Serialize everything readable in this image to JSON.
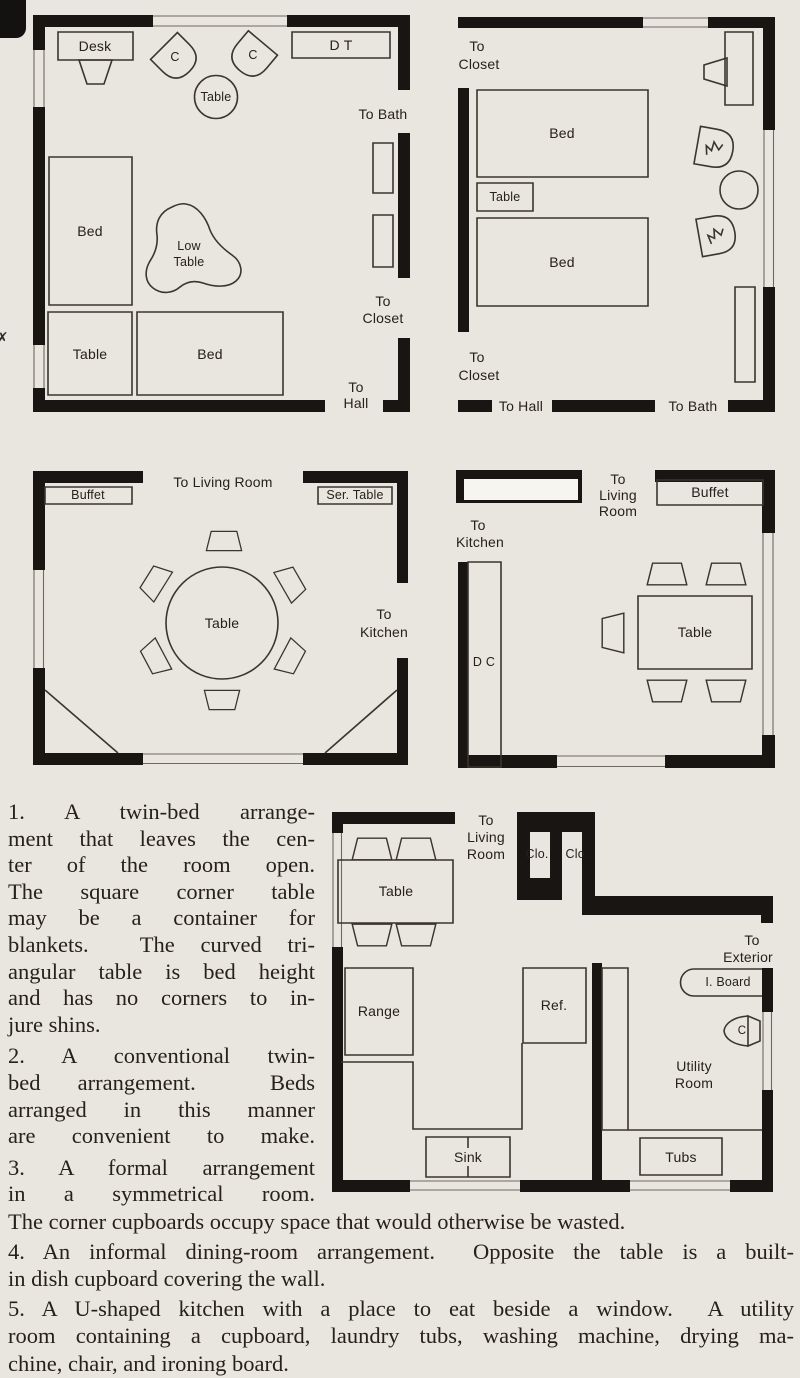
{
  "colors": {
    "page_bg": "#e9e6e0",
    "wall_black": "#191512",
    "furniture_stroke": "#3a362e",
    "ink": "#262119"
  },
  "plan1": {
    "desk": "Desk",
    "chair_left": "C",
    "chair_right": "C",
    "round_table": "Table",
    "dressing_table": "D T",
    "bed_left": "Bed",
    "low_table_line1": "Low",
    "low_table_line2": "Table",
    "corner_table": "Table",
    "bed_bottom": "Bed",
    "to_bath": "To Bath",
    "to_closet_line1": "To",
    "to_closet_line2": "Closet",
    "to_hall_line1": "To",
    "to_hall_line2": "Hall"
  },
  "plan2": {
    "to_closet_top_line1": "To",
    "to_closet_top_line2": "Closet",
    "bed_top": "Bed",
    "table": "Table",
    "bed_bottom": "Bed",
    "to_closet_bottom_line1": "To",
    "to_closet_bottom_line2": "Closet",
    "to_hall": "To Hall",
    "to_bath": "To Bath"
  },
  "plan3": {
    "to_living_room": "To Living Room",
    "buffet": "Buffet",
    "ser_table": "Ser. Table",
    "table": "Table",
    "to_kitchen_line1": "To",
    "to_kitchen_line2": "Kitchen"
  },
  "plan4": {
    "to_living_room_line1": "To",
    "to_living_room_line2": "Living",
    "to_living_room_line3": "Room",
    "buffet": "Buffet",
    "to_kitchen_line1": "To",
    "to_kitchen_line2": "Kitchen",
    "dish_cupboard": "D C",
    "table": "Table"
  },
  "plan5": {
    "to_living_room_line1": "To",
    "to_living_room_line2": "Living",
    "to_living_room_line3": "Room",
    "closet1": "Clo.",
    "closet2": "Clo.",
    "table": "Table",
    "range": "Range",
    "refrigerator": "Ref.",
    "sink": "Sink",
    "to_exterior_line1": "To",
    "to_exterior_line2": "Exterior",
    "ironing_board": "I. Board",
    "chair": "C",
    "utility_room_line1": "Utility",
    "utility_room_line2": "Room",
    "tubs": "Tubs"
  },
  "captions": {
    "item1_lines": [
      "1. A twin-bed arrange-",
      "ment that leaves the cen-",
      "ter of the room open.",
      "The square corner table",
      "may be a container for",
      "blankets.  The curved tri-",
      "angular table is bed height",
      "and has no corners to in-",
      "jure shins."
    ],
    "item2_lines": [
      "2. A conventional twin-",
      "bed arrangement.  Beds",
      "arranged in this manner",
      "are convenient to make."
    ],
    "item3_lines": [
      "3. A formal arrangement",
      "in a symmetrical room."
    ],
    "bottom_lines": [
      "The corner cupboards occupy space that would otherwise be wasted.",
      "4. An informal dining-room arrangement.  Opposite the table is a built-",
      "in dish cupboard covering the wall.",
      "5. A U-shaped kitchen with a place to eat beside a window.  A utility",
      "room containing a cupboard, laundry tubs, washing machine, drying ma-",
      "chine, chair, and ironing board."
    ],
    "margin_mark": "✗"
  }
}
